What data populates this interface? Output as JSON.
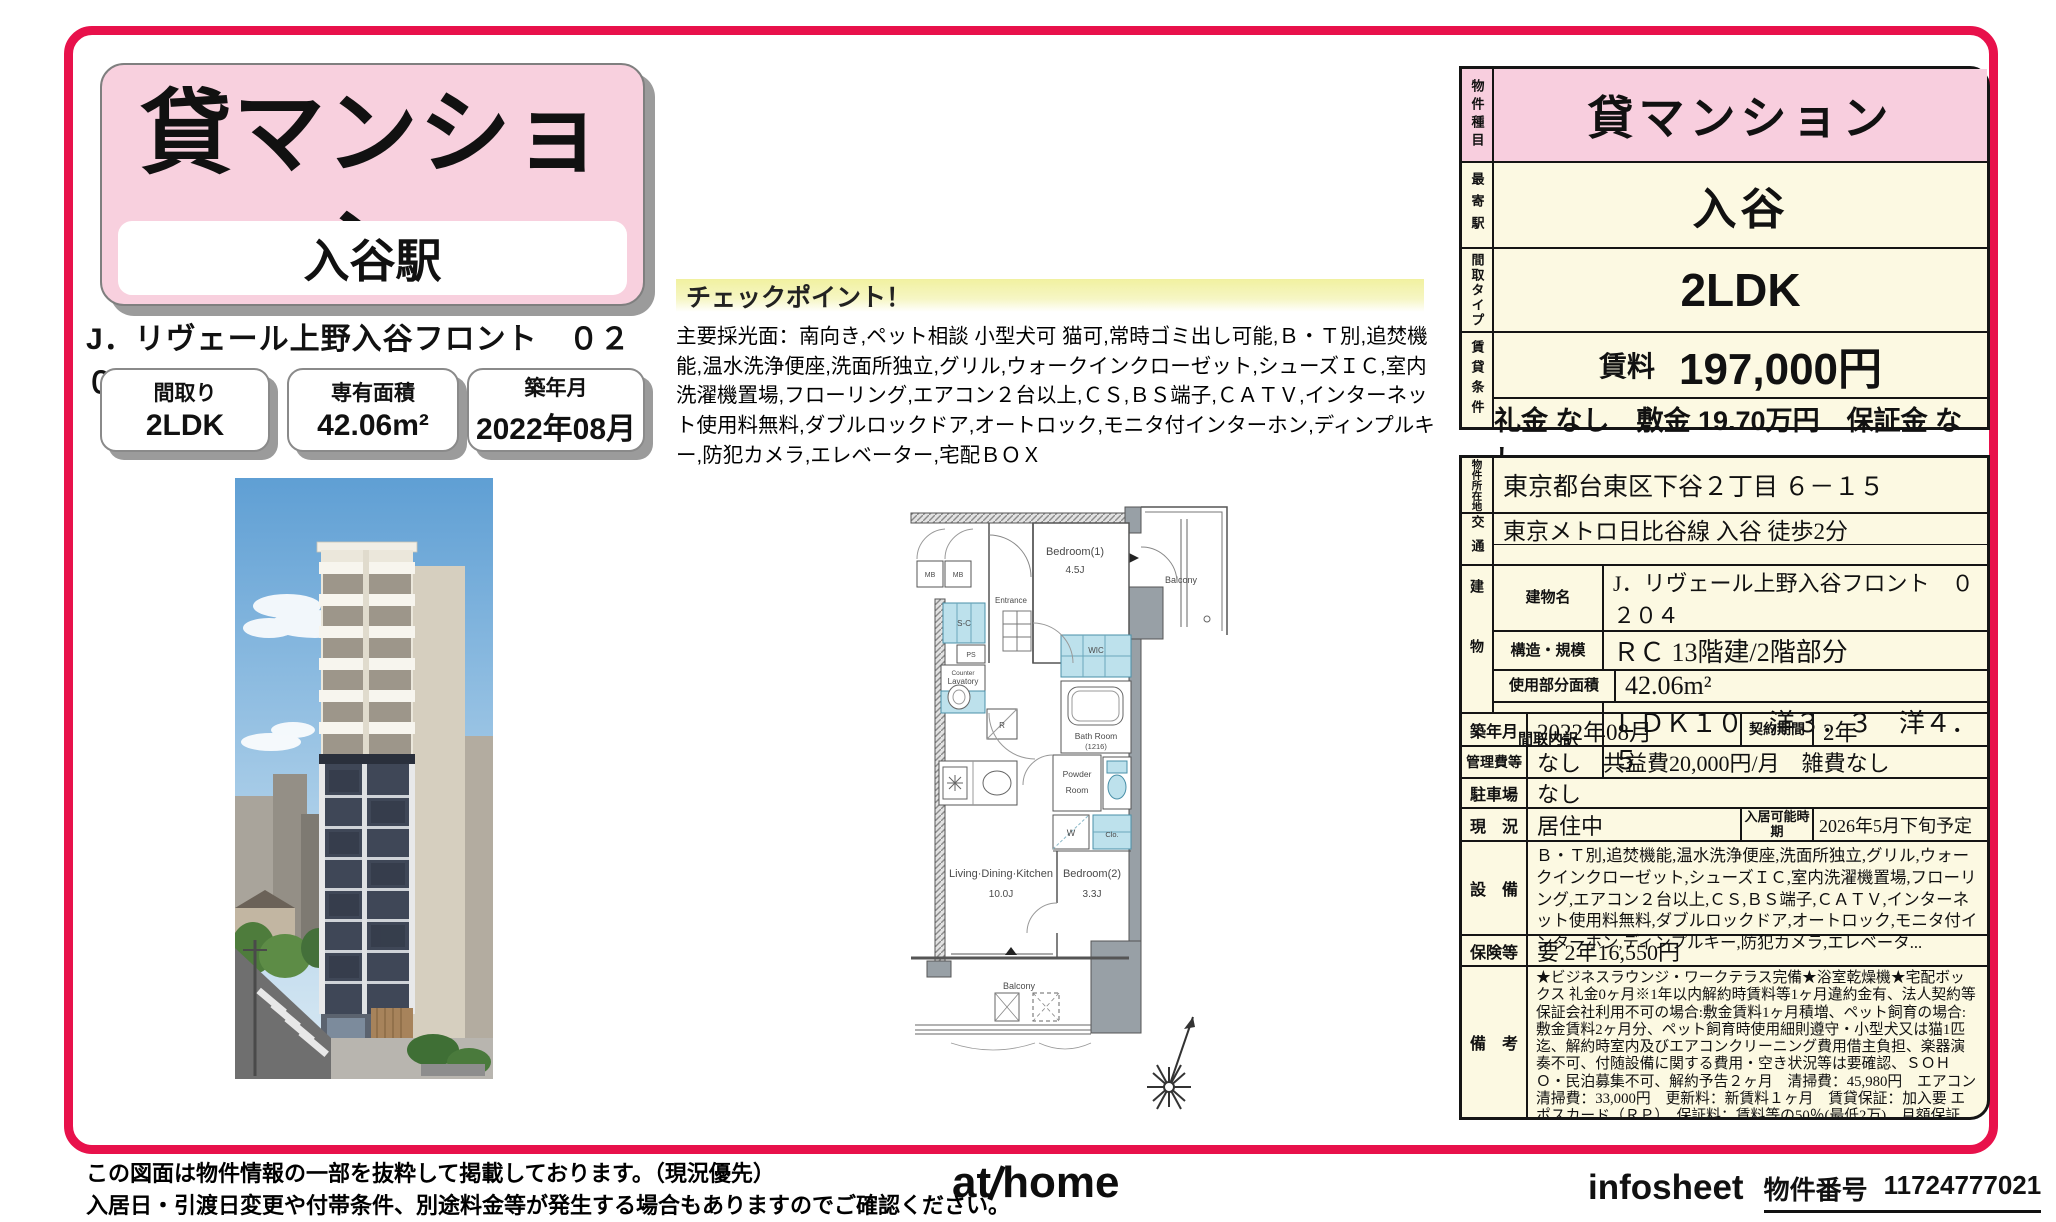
{
  "flyer": {
    "type_badge": "貸マンション",
    "station_badge": "入谷駅",
    "property_title": "J．リヴェール上野入谷フロント　０２０４",
    "spec_boxes": [
      {
        "label": "間取り",
        "value": "2LDK"
      },
      {
        "label": "専有面積",
        "value": "42.06m²"
      },
      {
        "label": "築年月",
        "value": "2022年08月"
      }
    ]
  },
  "checkpoint": {
    "title": "チェックポイント！",
    "body": "主要採光面：南向き,ペット相談 小型犬可 猫可,常時ゴミ出し可能,Ｂ・Ｔ別,追焚機能,温水洗浄便座,洗面所独立,グリル,ウォークインクローゼット,シューズＩＣ,室内洗濯機置場,フローリング,エアコン２台以上,ＣＳ,ＢＳ端子,ＣＡＴＶ,インターネット使用料無料,ダブルロックドア,オートロック,モニタ付インターホン,ディンプルキー,防犯カメラ,エレベーター,宅配ＢＯＸ"
  },
  "summary": {
    "type_label": "物件種目",
    "type_value": "貸マンション",
    "station_label": "最寄駅",
    "station_value": "入谷",
    "layout_label": "間取タイプ",
    "layout_value": "2LDK",
    "terms_label": "賃貸条件",
    "rent_caption": "賃料",
    "rent_value": "197,000円",
    "terms_line": "礼金 なし　敷金 19.70万円　保証金 なし"
  },
  "detail": {
    "address_label": "物件所在地",
    "address": "東京都台東区下谷２丁目 ６－１５",
    "access_label": "交通",
    "access_line1": "東京メトロ日比谷線 入谷 徒歩2分",
    "access_line2": "",
    "building_label": "建物",
    "building_rows": [
      {
        "label": "建物名",
        "value": "J．リヴェール上野入谷フロント　０２０４"
      },
      {
        "label": "構造・規模",
        "value": "ＲＣ 13階建/2階部分"
      },
      {
        "label": "使用部分面積",
        "value": "42.06m²"
      },
      {
        "label": "間取内訳",
        "value": "ＬＤＫ１０　洋３．３　洋４．５"
      }
    ],
    "year_label": "築年月",
    "year": "2022年08月",
    "contract_label": "契約期間",
    "contract": "2年",
    "mgmt_label": "管理費等",
    "mgmt": "なし　共益費20,000円/月　雑費なし",
    "parking_label": "駐車場",
    "parking": "なし",
    "status_label": "現　況",
    "status": "居住中",
    "movein_label": "入居可能時期",
    "movein": "2026年5月下旬予定",
    "equip_label": "設　備",
    "equip": "Ｂ・Ｔ別,追焚機能,温水洗浄便座,洗面所独立,グリル,ウォークインクローゼット,シューズＩＣ,室内洗濯機置場,フローリング,エアコン２台以上,ＣＳ,ＢＳ端子,ＣＡＴＶ,インターネット使用料無料,ダブルロックドア,オートロック,モニタ付インターホン,ディンプルキー,防犯カメラ,エレベータ...",
    "insurance_label": "保険等",
    "insurance": "要 2年16,550円",
    "remarks_label": "備　考",
    "remarks": "★ビジネスラウンジ・ワークテラス完備★浴室乾燥機★宅配ボックス 礼金0ヶ月※1年以内解約時賃料等1ヶ月違約金有、法人契約等保証会社利用不可の場合:敷金賃料1ヶ月積増、ペット飼育の場合:敷金賃料2ヶ月分、ペット飼育時使用細則遵守・小型犬又は猫1匹迄、解約時室内及びエアコンクリーニング費用借主負担、楽器演奏不可、付随設備に関する費用・空き状況等は要確認、ＳＯＨＯ・民泊募集不可、解約予告２ヶ月　清掃費：45,980円　エアコン清掃費：33,000円　更新料：新賃料１ヶ月　賃貸保証：加入要 エポスカード（ＲＰ）　保証料：賃料等の50％(最低2万)、月額保証料：賃料等の1％(更新料無)\n利用駅１：ＪＲ山手線 鶯谷 徒歩7分　利用駅２：ＪＲ山手線 上野 徒歩12分"
  },
  "floorplan": {
    "bedroom1": "Bedroom(1)",
    "bedroom1_size": "4.5J",
    "balcony_top": "Balcony",
    "mb1": "MB",
    "mb2": "MB",
    "entrance": "Entrance",
    "sc": "S-C",
    "ps": "PS",
    "counter": "Counter",
    "lavatory": "Lavatory",
    "wic": "WIC",
    "bath1": "Bath Room",
    "bath2": "(1216)",
    "powder1": "Powder",
    "powder2": "Room",
    "w": "W",
    "clo": "Clo.",
    "r": "R",
    "ldk": "Living·Dining·Kitchen",
    "ldk_size": "10.0J",
    "bedroom2": "Bedroom(2)",
    "bedroom2_size": "3.3J",
    "balcony_bottom": "Balcony"
  },
  "footer": {
    "note1": "この図面は物件情報の一部を抜粋して掲載しております。（現況優先）",
    "note2": "入居日・引渡日変更や付帯条件、別途料金等が発生する場合もありますのでご確認ください。",
    "logo_at": "at",
    "logo_home": "home",
    "infosheet": "infosheet",
    "property_no_label": "物件番号",
    "property_no": "11724777021"
  },
  "colors": {
    "accent": "#e8114b",
    "table_bg": "#fcf9e2",
    "pink": "#f8cede",
    "wet_blue": "#bde1ec"
  }
}
